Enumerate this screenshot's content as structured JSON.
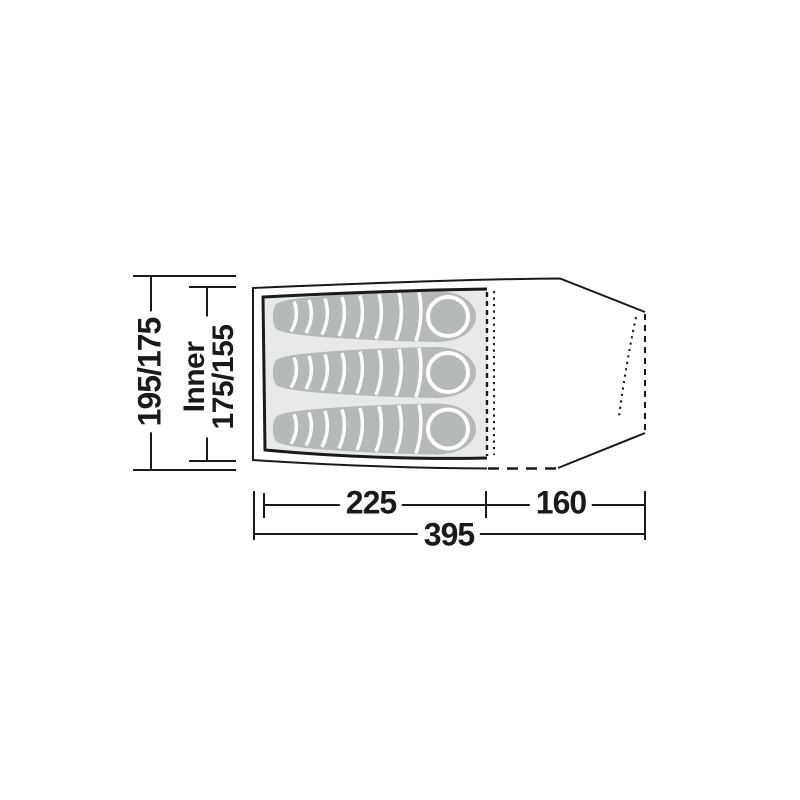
{
  "diagram": {
    "type": "tent-floorplan-top-view",
    "labels": {
      "outer_height": "195/175",
      "inner_prefix": "Inner",
      "inner_height": "175/155",
      "inner_length": "225",
      "porch_length": "160",
      "total_length": "395"
    },
    "sleeping_bags_count": 3,
    "colors": {
      "line": "#1a1a1a",
      "inner_fill": "#e8eae8",
      "bag_fill": "#b6bab6",
      "bag_divider": "#ffffff"
    }
  }
}
